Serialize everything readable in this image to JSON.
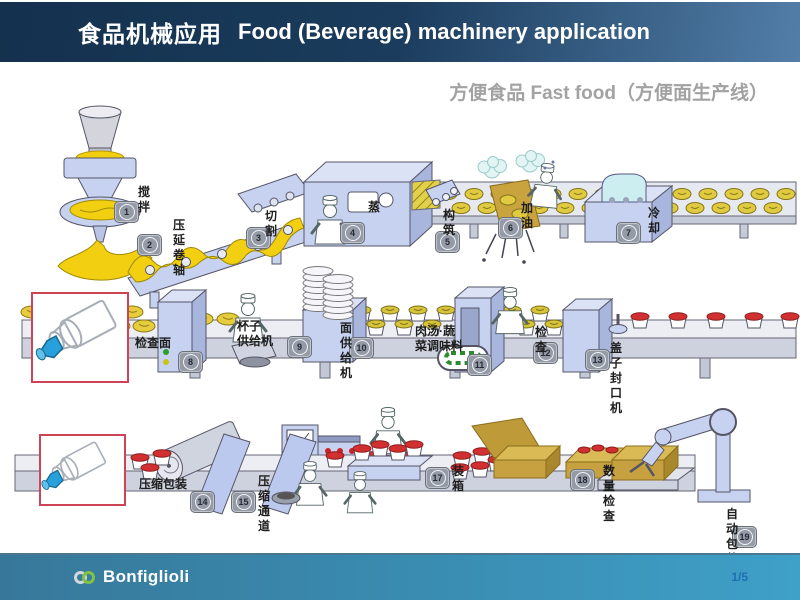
{
  "header": {
    "title_cn": "食品机械应用",
    "title_en": "Food (Beverage) machinery application"
  },
  "subtitle": "方便食品 Fast food（方便面生产线）",
  "stations": [
    {
      "num": "1",
      "label": "搅拌"
    },
    {
      "num": "2",
      "label": "压延卷轴"
    },
    {
      "num": "3",
      "label": "切割"
    },
    {
      "num": "4",
      "label": "蒸"
    },
    {
      "num": "5",
      "label": "构筑"
    },
    {
      "num": "6",
      "label": "加油"
    },
    {
      "num": "7",
      "label": "冷却"
    },
    {
      "num": "8",
      "label": "检查面"
    },
    {
      "num": "9",
      "label": "杯子\n供给机"
    },
    {
      "num": "10",
      "label": "面供给机"
    },
    {
      "num": "11",
      "label": "肉汤·蔬\n菜调味料"
    },
    {
      "num": "12",
      "label": "检查"
    },
    {
      "num": "13",
      "label": "盖子封口机"
    },
    {
      "num": "14",
      "label": "压缩包装"
    },
    {
      "num": "15",
      "label": "压缩通道"
    },
    {
      "num": "16",
      "label": ""
    },
    {
      "num": "17",
      "label": "装箱"
    },
    {
      "num": "18",
      "label": "数量检查"
    },
    {
      "num": "19",
      "label": "自动包装"
    }
  ],
  "footer": {
    "brand": "Bonfiglioli",
    "page": "1/5"
  },
  "icons": {
    "logo": "interlocked-rings-icon"
  },
  "colors": {
    "header_dark": "#14314e",
    "header_light": "#527ea8",
    "footer_teal": "#3fa0c8",
    "machine_periwinkle": "#c7d2f0",
    "dough_yellow": "#f2cf10",
    "lid_red": "#d23030",
    "box_tan": "#c7a13f",
    "inset_border": "#cc4455",
    "gearbox_blue": "#28a0dc"
  }
}
